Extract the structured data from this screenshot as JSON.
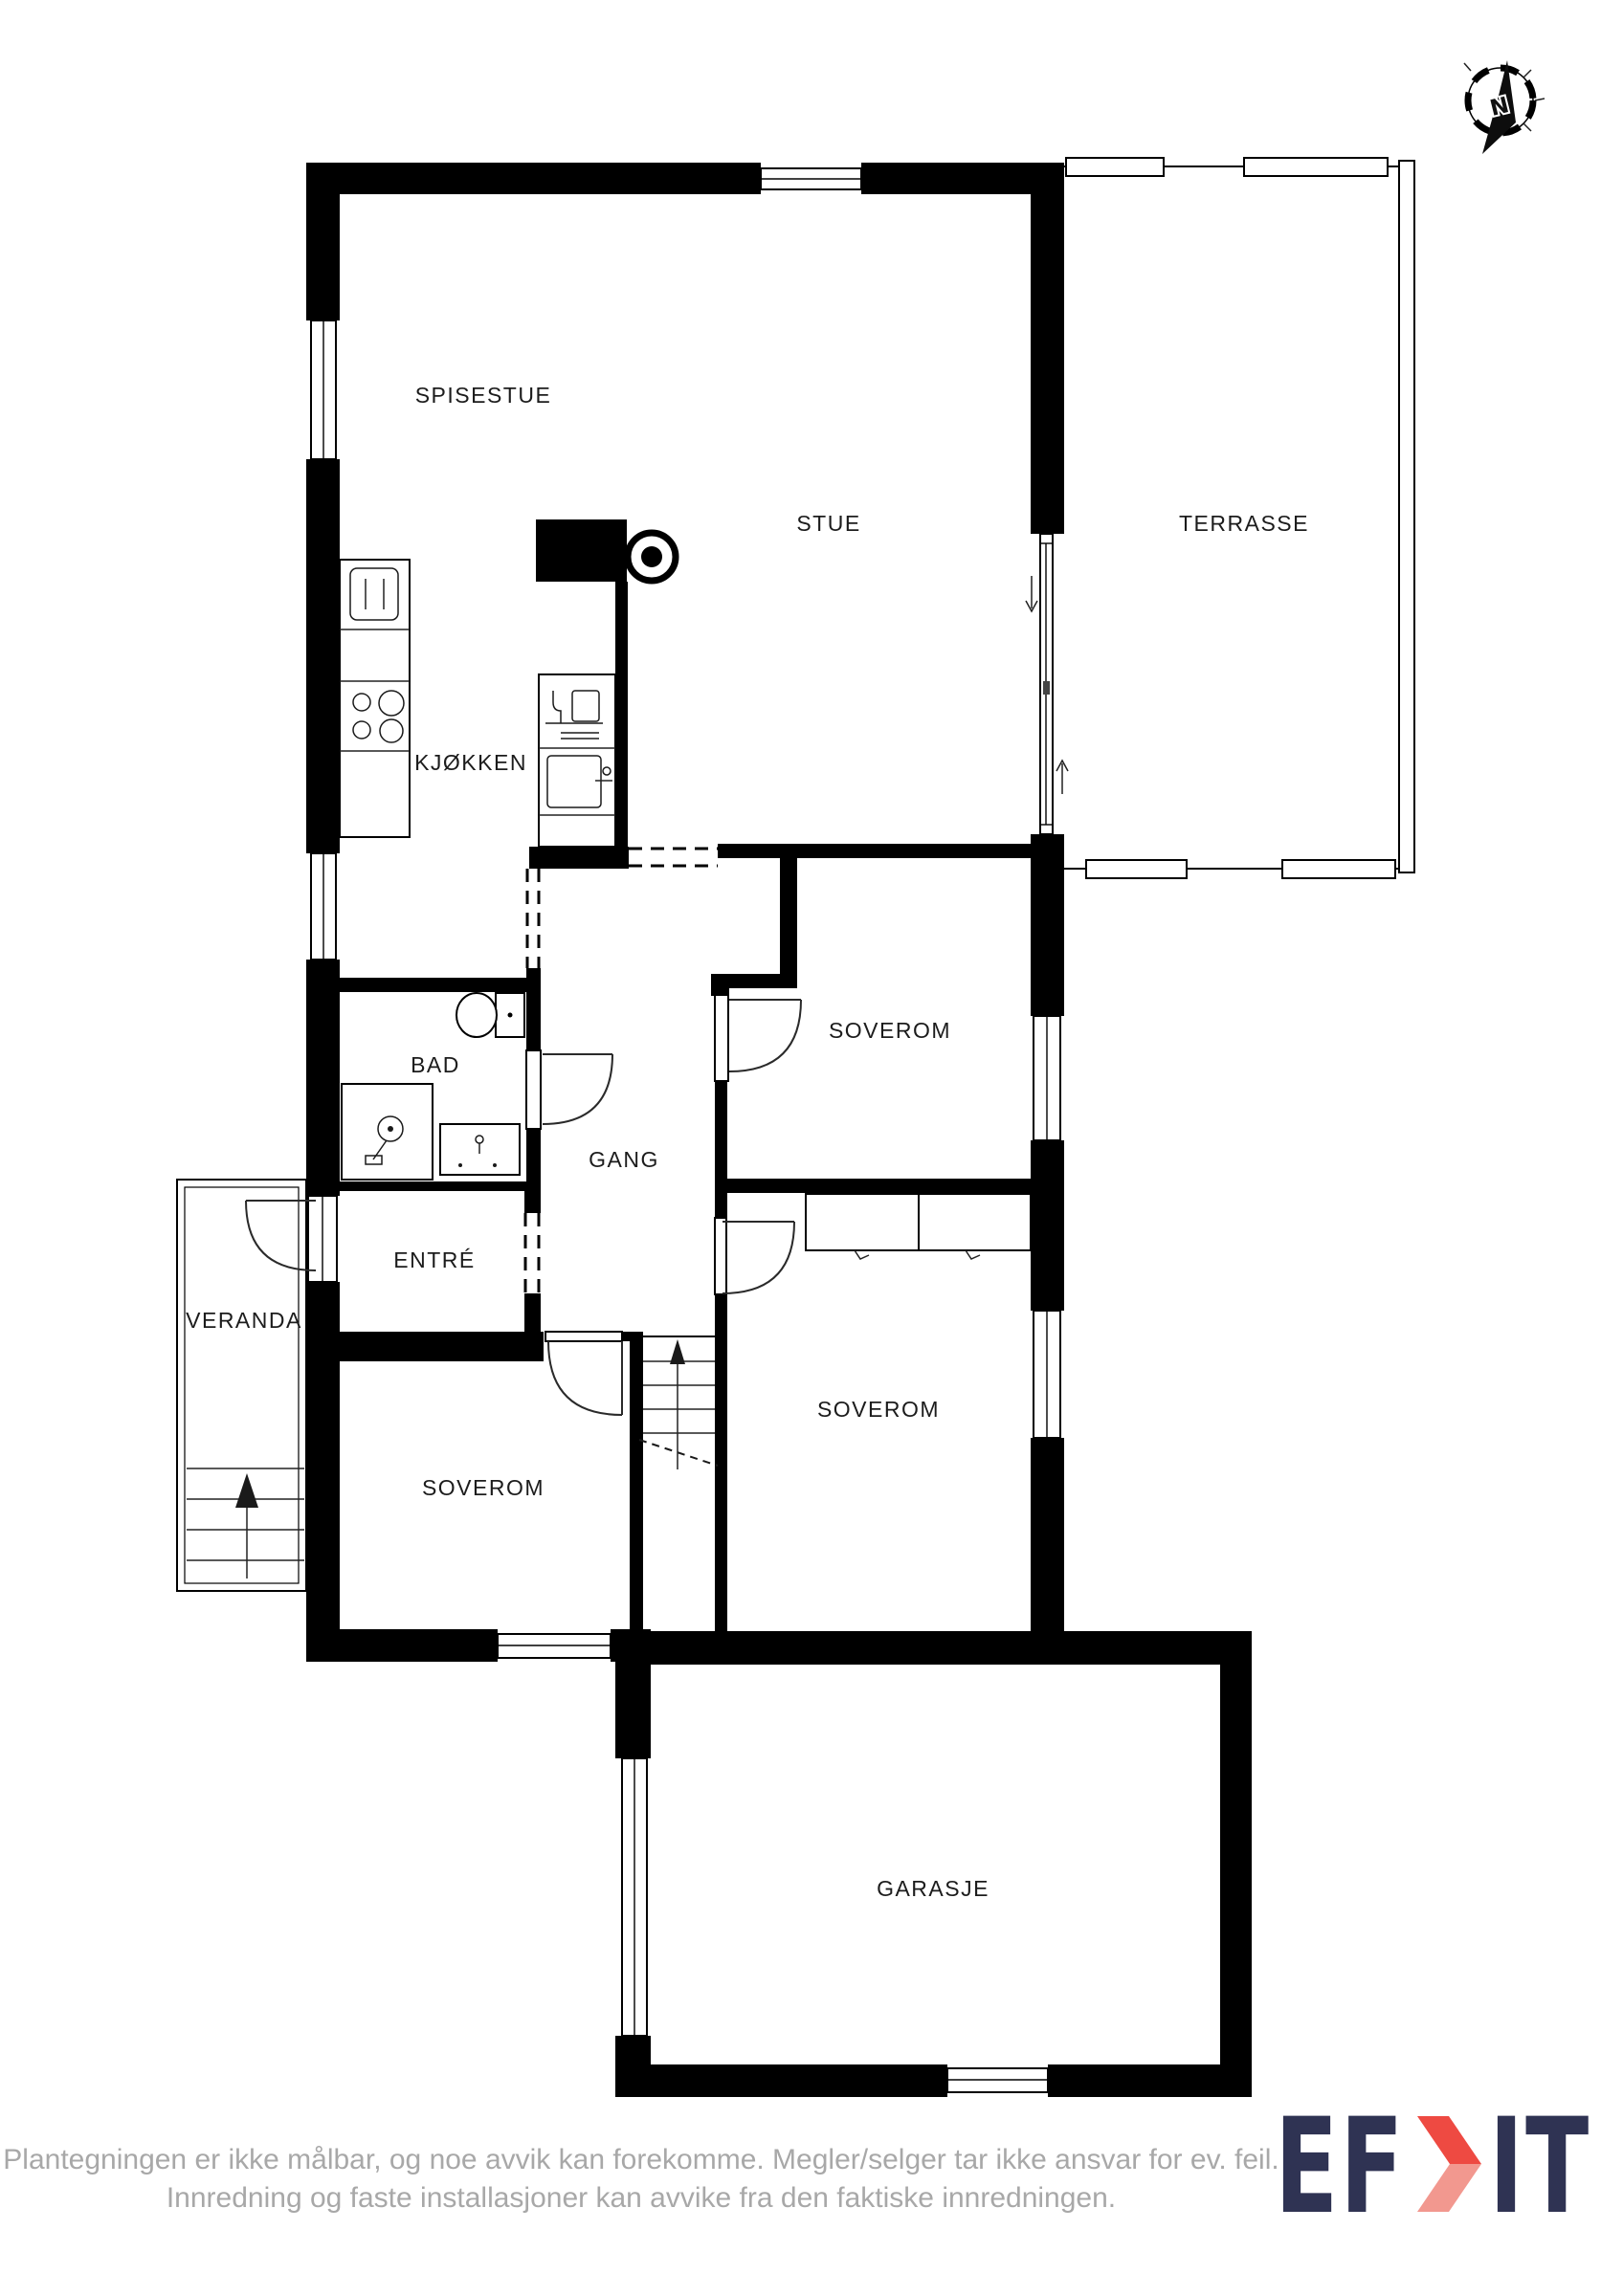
{
  "floorplan": {
    "rooms": [
      {
        "id": "spisestue",
        "label": "SPISESTUE"
      },
      {
        "id": "stue",
        "label": "STUE"
      },
      {
        "id": "terrasse",
        "label": "TERRASSE"
      },
      {
        "id": "kjokken",
        "label": "KJØKKEN"
      },
      {
        "id": "bad",
        "label": "BAD"
      },
      {
        "id": "gang",
        "label": "GANG"
      },
      {
        "id": "soverom-ost",
        "label": "SOVEROM"
      },
      {
        "id": "entre",
        "label": "ENTRÉ"
      },
      {
        "id": "veranda",
        "label": "VERANDA"
      },
      {
        "id": "soverom-sor-ost",
        "label": "SOVEROM"
      },
      {
        "id": "soverom-sor-vest",
        "label": "SOVEROM"
      },
      {
        "id": "garasje",
        "label": "GARASJE"
      }
    ],
    "compass": {
      "north_label": "N"
    },
    "colors": {
      "wall": "#000000",
      "line": "#1c1c1c"
    }
  },
  "footer": {
    "disclaimer_line1": "Plantegningen er ikke målbar, og noe avvik kan forekomme. Megler/selger tar ikke ansvar for ev. feil.",
    "disclaimer_line2": "Innredning og faste installasjoner kan avvike fra den faktiske innredningen.",
    "text_color": "#a8a8a8"
  },
  "logo": {
    "part1": "EF",
    "part2": "IT",
    "text_color": "#2f3353",
    "accent_top": "#ee4a42",
    "accent_bottom": "#f2988f"
  }
}
